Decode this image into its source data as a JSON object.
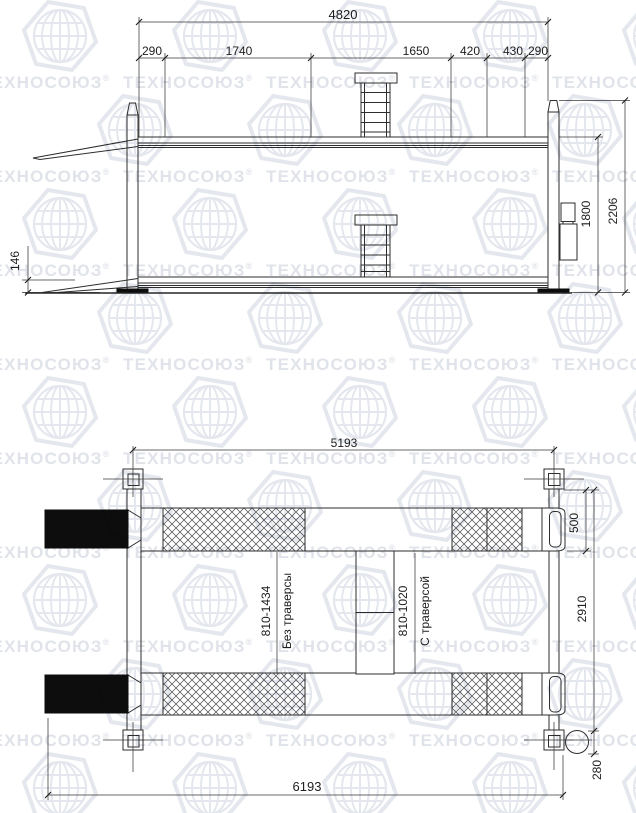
{
  "watermark": {
    "brand": "ТЕХНОСОЮЗ",
    "registered": "®",
    "icon": "globe-icon",
    "text_color": "#e0e3e9",
    "globe_color": "#e4e7ed"
  },
  "side_view": {
    "dim_overall_length": "4820",
    "dim_segments": [
      "290",
      "1740",
      "1650",
      "420",
      "430",
      "290"
    ],
    "dim_column_height": "2206",
    "dim_lift_height": "1800",
    "dim_lowered_height": "146"
  },
  "plan_view": {
    "dim_post_span": "5193",
    "dim_overall_length": "6193",
    "dim_runway_width": "500",
    "dim_overall_width": "2910",
    "dim_motor_diameter": "280",
    "label_no_traverse_range": "810-1434",
    "label_no_traverse": "Без траверсы",
    "label_traverse_range": "810-1020",
    "label_traverse": "С траверсой"
  }
}
